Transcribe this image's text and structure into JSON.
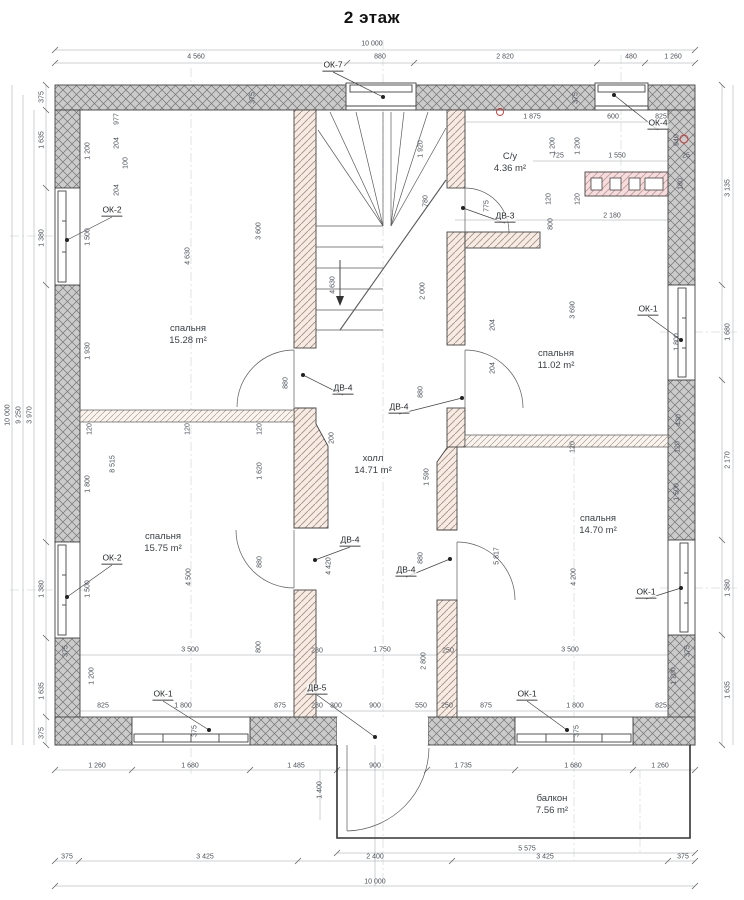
{
  "title": "2 этаж",
  "colors": {
    "outer_wall": "#cccccc",
    "outer_wall_hatch": "#757575",
    "inner_wall": "#f6ece5",
    "inner_wall_hatch": "#a8907c",
    "vent_block": "#f6dcdc",
    "vent_block_hatch": "#c49a9a",
    "dim_text": "#4a5058",
    "axis_mark_red": "#cc3333"
  },
  "rooms": [
    {
      "name": "спальня",
      "area": "15.28 m²",
      "x": 188,
      "y": 335
    },
    {
      "name": "спальня",
      "area": "11.02 m²",
      "x": 556,
      "y": 360
    },
    {
      "name": "С/у",
      "area": "4.36 m²",
      "x": 510,
      "y": 163
    },
    {
      "name": "холл",
      "area": "14.71 m²",
      "x": 373,
      "y": 465
    },
    {
      "name": "спальня",
      "area": "15.75 m²",
      "x": 163,
      "y": 543
    },
    {
      "name": "спальня",
      "area": "14.70 m²",
      "x": 598,
      "y": 525
    },
    {
      "name": "балкон",
      "area": "7.56 m²",
      "x": 552,
      "y": 805
    }
  ],
  "windows": [
    {
      "id": "ОК-7",
      "lx": 333,
      "ly": 72,
      "dx": 383,
      "dy": 97
    },
    {
      "id": "ОК-4",
      "lx": 658,
      "ly": 130,
      "dx": 614,
      "dy": 95
    },
    {
      "id": "ОК-2",
      "lx": 112,
      "ly": 217,
      "dx": 67,
      "dy": 240
    },
    {
      "id": "ОК-2",
      "lx": 112,
      "ly": 565,
      "dx": 67,
      "dy": 597
    },
    {
      "id": "ОК-1",
      "lx": 648,
      "ly": 316,
      "dx": 681,
      "dy": 340
    },
    {
      "id": "ОК-1",
      "lx": 646,
      "ly": 599,
      "dx": 681,
      "dy": 588
    },
    {
      "id": "ОК-1",
      "lx": 163,
      "ly": 701,
      "dx": 209,
      "dy": 730
    },
    {
      "id": "ОК-1",
      "lx": 527,
      "ly": 701,
      "dx": 567,
      "dy": 730
    }
  ],
  "doors": [
    {
      "id": "ДВ-3",
      "lx": 505,
      "ly": 223,
      "dx": 463,
      "dy": 208
    },
    {
      "id": "ДВ-4",
      "lx": 343,
      "ly": 395,
      "dx": 303,
      "dy": 375
    },
    {
      "id": "ДВ-4",
      "lx": 399,
      "ly": 414,
      "dx": 462,
      "dy": 398
    },
    {
      "id": "ДВ-4",
      "lx": 350,
      "ly": 547,
      "dx": 315,
      "dy": 560
    },
    {
      "id": "ДВ-4",
      "lx": 406,
      "ly": 577,
      "dx": 450,
      "dy": 559
    },
    {
      "id": "ДВ-5",
      "lx": 317,
      "ly": 695,
      "dx": 375,
      "dy": 737
    }
  ],
  "dimensions": [
    [
      "10 000",
      372,
      44,
      0
    ],
    [
      "4 560",
      196,
      57,
      0
    ],
    [
      "880",
      380,
      57,
      0
    ],
    [
      "2 820",
      505,
      57,
      0
    ],
    [
      "480",
      631,
      57,
      0
    ],
    [
      "1 260",
      673,
      57,
      0
    ],
    [
      "375",
      253,
      98,
      1
    ],
    [
      "375",
      576,
      98,
      1
    ],
    [
      "1 875",
      532,
      117,
      0
    ],
    [
      "600",
      613,
      117,
      0
    ],
    [
      "825",
      661,
      117,
      0
    ],
    [
      "940",
      677,
      140,
      1
    ],
    [
      "725",
      558,
      156,
      0
    ],
    [
      "1 550",
      617,
      156,
      0
    ],
    [
      "25",
      686,
      156,
      0
    ],
    [
      "120",
      549,
      199,
      1
    ],
    [
      "120",
      578,
      199,
      1
    ],
    [
      "800",
      551,
      224,
      1
    ],
    [
      "180",
      681,
      184,
      1
    ],
    [
      "2 180",
      612,
      216,
      0
    ],
    [
      "1 200",
      553,
      146,
      1
    ],
    [
      "1 200",
      578,
      146,
      1
    ],
    [
      "977",
      117,
      119,
      1
    ],
    [
      "204",
      117,
      143,
      1
    ],
    [
      "100",
      126,
      163,
      1
    ],
    [
      "204",
      117,
      190,
      1
    ],
    [
      "1 200",
      88,
      151,
      1
    ],
    [
      "1 500",
      88,
      237,
      1
    ],
    [
      "1 930",
      88,
      351,
      1
    ],
    [
      "4 630",
      188,
      256,
      1
    ],
    [
      "3 600",
      259,
      231,
      1
    ],
    [
      "4 630",
      333,
      285,
      1
    ],
    [
      "1 920",
      421,
      149,
      1
    ],
    [
      "780",
      426,
      201,
      1
    ],
    [
      "775",
      487,
      206,
      1
    ],
    [
      "2 000",
      423,
      291,
      1
    ],
    [
      "3 690",
      573,
      310,
      1
    ],
    [
      "1 800",
      677,
      342,
      1
    ],
    [
      "3 135",
      728,
      188,
      1
    ],
    [
      "1 680",
      728,
      332,
      1
    ],
    [
      "204",
      493,
      325,
      1
    ],
    [
      "204",
      493,
      368,
      1
    ],
    [
      "880",
      286,
      383,
      1
    ],
    [
      "880",
      421,
      392,
      1
    ],
    [
      "200",
      332,
      438,
      1
    ],
    [
      "375",
      42,
      97,
      1
    ],
    [
      "1 635",
      42,
      140,
      1
    ],
    [
      "1 380",
      42,
      238,
      1
    ],
    [
      "1 380",
      42,
      589,
      1
    ],
    [
      "1 635",
      42,
      691,
      1
    ],
    [
      "375",
      42,
      733,
      1
    ],
    [
      "10 000",
      8,
      415,
      1
    ],
    [
      "9 250",
      19,
      415,
      1
    ],
    [
      "3 970",
      30,
      415,
      1
    ],
    [
      "120",
      90,
      429,
      1
    ],
    [
      "120",
      188,
      429,
      1
    ],
    [
      "120",
      260,
      429,
      1
    ],
    [
      "120",
      573,
      447,
      1
    ],
    [
      "120",
      678,
      447,
      1
    ],
    [
      "8 515",
      113,
      464,
      1
    ],
    [
      "1 800",
      88,
      484,
      1
    ],
    [
      "1 620",
      260,
      471,
      1
    ],
    [
      "1 590",
      427,
      477,
      1
    ],
    [
      "4 500",
      189,
      577,
      1
    ],
    [
      "1 500",
      88,
      589,
      1
    ],
    [
      "880",
      260,
      562,
      1
    ],
    [
      "880",
      421,
      558,
      1
    ],
    [
      "4 420",
      329,
      566,
      1
    ],
    [
      "5 817",
      497,
      556,
      1
    ],
    [
      "4 200",
      574,
      577,
      1
    ],
    [
      "430",
      679,
      420,
      1
    ],
    [
      "1 500",
      677,
      492,
      1
    ],
    [
      "2 170",
      728,
      460,
      1
    ],
    [
      "1 380",
      728,
      588,
      1
    ],
    [
      "3 500",
      190,
      650,
      0
    ],
    [
      "280",
      317,
      651,
      0
    ],
    [
      "1 750",
      382,
      650,
      0
    ],
    [
      "250",
      448,
      651,
      0
    ],
    [
      "3 500",
      570,
      650,
      0
    ],
    [
      "2 800",
      424,
      661,
      1
    ],
    [
      "800",
      259,
      647,
      1
    ],
    [
      "375",
      66,
      651,
      1
    ],
    [
      "375",
      688,
      651,
      1
    ],
    [
      "1 200",
      92,
      676,
      1
    ],
    [
      "1 200",
      674,
      676,
      1
    ],
    [
      "825",
      103,
      706,
      0
    ],
    [
      "1 800",
      183,
      706,
      0
    ],
    [
      "875",
      280,
      706,
      0
    ],
    [
      "280",
      317,
      706,
      0
    ],
    [
      "300",
      336,
      706,
      0
    ],
    [
      "900",
      375,
      706,
      0
    ],
    [
      "550",
      421,
      706,
      0
    ],
    [
      "250",
      447,
      706,
      0
    ],
    [
      "875",
      486,
      706,
      0
    ],
    [
      "1 800",
      575,
      706,
      0
    ],
    [
      "825",
      661,
      706,
      0
    ],
    [
      "375",
      195,
      731,
      1
    ],
    [
      "375",
      577,
      731,
      1
    ],
    [
      "1 260",
      97,
      766,
      0
    ],
    [
      "1 680",
      190,
      766,
      0
    ],
    [
      "1 485",
      296,
      766,
      0
    ],
    [
      "900",
      375,
      766,
      0
    ],
    [
      "1 735",
      463,
      766,
      0
    ],
    [
      "1 680",
      573,
      766,
      0
    ],
    [
      "1 260",
      660,
      766,
      0
    ],
    [
      "1 400",
      320,
      790,
      1
    ],
    [
      "5 575",
      527,
      849,
      0
    ],
    [
      "375",
      67,
      857,
      0
    ],
    [
      "3 425",
      205,
      857,
      0
    ],
    [
      "2 400",
      375,
      857,
      0
    ],
    [
      "3 425",
      545,
      857,
      0
    ],
    [
      "375",
      683,
      857,
      0
    ],
    [
      "10 000",
      375,
      882,
      0
    ],
    [
      "1 635",
      728,
      690,
      1
    ]
  ]
}
